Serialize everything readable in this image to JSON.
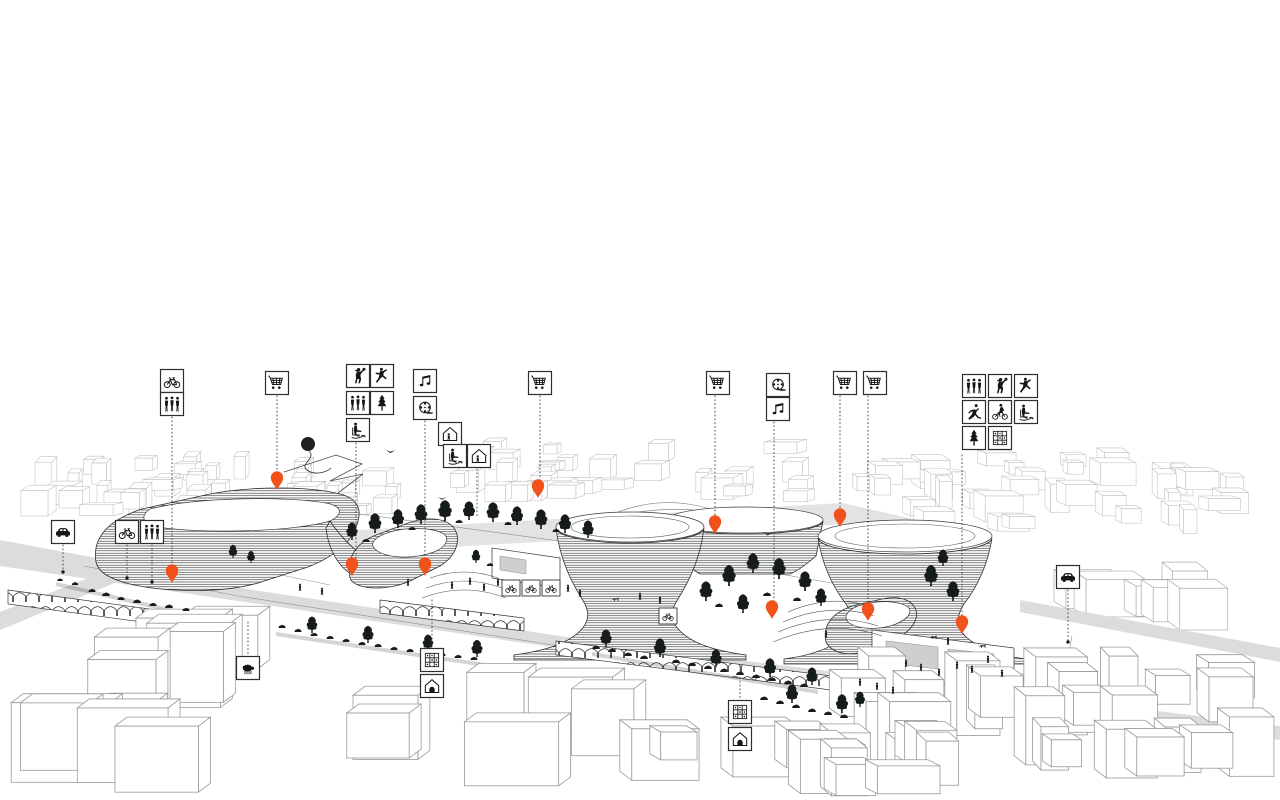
{
  "meta": {
    "type": "architectural-axonometric-masterplan-illustration",
    "canvas": {
      "w": 1280,
      "h": 800
    }
  },
  "colors": {
    "background": "#ffffff",
    "ink": "#1c1c1c",
    "pin": "#f1511b",
    "tree": "#161d18",
    "line_far": "#c4c4c4",
    "line_mid": "#aeaeae",
    "line_near": "#9a9a9a",
    "road": "#dcdcdc",
    "window": "#cfcfcf"
  },
  "legend": {
    "box_size": 23,
    "icons": [
      {
        "name": "car-icon",
        "symbol": "car",
        "x": 63,
        "y": 532
      },
      {
        "name": "bicycle-icon",
        "symbol": "bicycle",
        "x": 127,
        "y": 532
      },
      {
        "name": "pedestrians-icon",
        "symbol": "pedestrians",
        "x": 152,
        "y": 532
      },
      {
        "name": "bicycle-icon",
        "symbol": "bicycle",
        "x": 172,
        "y": 381
      },
      {
        "name": "pedestrians-icon",
        "symbol": "pedestrians",
        "x": 172,
        "y": 404
      },
      {
        "name": "shopping-icon",
        "symbol": "cart",
        "x": 277,
        "y": 383
      },
      {
        "name": "basketball-icon",
        "symbol": "basketball",
        "x": 358,
        "y": 376
      },
      {
        "name": "dance-icon",
        "symbol": "dancer",
        "x": 382,
        "y": 376
      },
      {
        "name": "pedestrians-icon",
        "symbol": "pedestrians",
        "x": 358,
        "y": 403
      },
      {
        "name": "tree-icon",
        "symbol": "tree",
        "x": 382,
        "y": 403
      },
      {
        "name": "rest-chair-icon",
        "symbol": "chairdog",
        "x": 358,
        "y": 430
      },
      {
        "name": "music-icon",
        "symbol": "music",
        "x": 425,
        "y": 381
      },
      {
        "name": "cinema-icon",
        "symbol": "film",
        "x": 425,
        "y": 408
      },
      {
        "name": "community-house-icon",
        "symbol": "houseperson",
        "x": 450,
        "y": 434
      },
      {
        "name": "rest-chair-icon",
        "symbol": "chairdog",
        "x": 455,
        "y": 456
      },
      {
        "name": "community-house-icon",
        "symbol": "houseperson",
        "x": 479,
        "y": 456
      },
      {
        "name": "shopping-icon",
        "symbol": "cart",
        "x": 540,
        "y": 383
      },
      {
        "name": "shopping-icon",
        "symbol": "cart",
        "x": 718,
        "y": 383
      },
      {
        "name": "cinema-icon",
        "symbol": "film",
        "x": 778,
        "y": 385
      },
      {
        "name": "music-icon",
        "symbol": "music",
        "x": 778,
        "y": 409
      },
      {
        "name": "shopping-icon",
        "symbol": "cart",
        "x": 845,
        "y": 383
      },
      {
        "name": "shopping-icon",
        "symbol": "cart",
        "x": 875,
        "y": 383
      },
      {
        "name": "pedestrians-icon",
        "symbol": "pedestrians",
        "x": 974,
        "y": 386
      },
      {
        "name": "basketball-icon",
        "symbol": "basketball",
        "x": 1000,
        "y": 386
      },
      {
        "name": "dance-icon",
        "symbol": "dancer",
        "x": 1026,
        "y": 386
      },
      {
        "name": "running-icon",
        "symbol": "runner",
        "x": 974,
        "y": 412
      },
      {
        "name": "cycling-icon",
        "symbol": "bmx",
        "x": 1000,
        "y": 412
      },
      {
        "name": "rest-chair-icon",
        "symbol": "chairdog",
        "x": 1026,
        "y": 412
      },
      {
        "name": "tree-icon",
        "symbol": "tree",
        "x": 974,
        "y": 438
      },
      {
        "name": "garden-plots-icon",
        "symbol": "grid",
        "x": 1000,
        "y": 438
      },
      {
        "name": "petting-farm-icon",
        "symbol": "sheep",
        "x": 248,
        "y": 668
      },
      {
        "name": "garden-plots-icon",
        "symbol": "grid",
        "x": 432,
        "y": 660
      },
      {
        "name": "housing-icon",
        "symbol": "homearch",
        "x": 432,
        "y": 686
      },
      {
        "name": "garden-plots-icon",
        "symbol": "grid",
        "x": 740,
        "y": 712
      },
      {
        "name": "housing-icon",
        "symbol": "homearch",
        "x": 740,
        "y": 739
      },
      {
        "name": "car-icon",
        "symbol": "car",
        "x": 1068,
        "y": 577
      }
    ]
  },
  "leader_lines": [
    [
      63,
      545,
      570
    ],
    [
      127,
      545,
      576
    ],
    [
      152,
      545,
      580
    ],
    [
      172,
      417,
      576
    ],
    [
      277,
      396,
      483
    ],
    [
      356,
      443,
      568
    ],
    [
      425,
      421,
      569
    ],
    [
      477,
      469,
      518
    ],
    [
      540,
      396,
      490
    ],
    [
      715,
      396,
      526
    ],
    [
      774,
      422,
      611
    ],
    [
      840,
      396,
      519
    ],
    [
      868,
      396,
      613
    ],
    [
      962,
      455,
      626
    ],
    [
      1068,
      590,
      640
    ],
    [
      248,
      622,
      655
    ],
    [
      432,
      600,
      647
    ],
    [
      740,
      666,
      699
    ]
  ],
  "ground_dots": [
    [
      63,
      572
    ],
    [
      127,
      578
    ],
    [
      152,
      582
    ],
    [
      1068,
      642
    ]
  ],
  "pins": [
    [
      172,
      583
    ],
    [
      277,
      490
    ],
    [
      352,
      576
    ],
    [
      425,
      576
    ],
    [
      538,
      498
    ],
    [
      715,
      534
    ],
    [
      840,
      527
    ],
    [
      772,
      619
    ],
    [
      868,
      621
    ],
    [
      962,
      634
    ]
  ],
  "scene_signs": [
    {
      "symbol": "bicycle",
      "x": 511,
      "y": 588
    },
    {
      "symbol": "bicycle",
      "x": 531,
      "y": 588
    },
    {
      "symbol": "bicycle",
      "x": 551,
      "y": 588
    },
    {
      "symbol": "bicycle",
      "x": 668,
      "y": 616
    }
  ],
  "balloon": {
    "x": 308,
    "y": 444,
    "r": 7
  },
  "birds": [
    [
      386,
      450,
      1.1
    ],
    [
      438,
      497,
      1.0
    ],
    [
      764,
      533,
      0.9
    ]
  ],
  "dogs": [
    [
      933,
      638
    ],
    [
      615,
      600
    ],
    [
      982,
      647
    ]
  ],
  "people": [
    [
      300,
      591
    ],
    [
      322,
      595
    ],
    [
      408,
      586
    ],
    [
      452,
      589
    ],
    [
      470,
      585
    ],
    [
      484,
      591
    ],
    [
      498,
      586
    ],
    [
      512,
      592
    ],
    [
      640,
      600
    ],
    [
      660,
      604
    ],
    [
      568,
      592
    ],
    [
      580,
      597
    ],
    [
      860,
      686
    ],
    [
      877,
      690
    ],
    [
      893,
      694
    ],
    [
      906,
      667
    ],
    [
      921,
      671
    ],
    [
      939,
      676
    ],
    [
      957,
      669
    ],
    [
      972,
      673
    ],
    [
      988,
      663
    ],
    [
      1002,
      677
    ],
    [
      948,
      645
    ],
    [
      826,
      638
    ]
  ],
  "trees": [
    [
      92,
      592,
      0.5,
      "b"
    ],
    [
      106,
      596,
      0.55,
      "b"
    ],
    [
      121,
      600,
      0.5,
      "b"
    ],
    [
      137,
      603,
      0.55,
      "b"
    ],
    [
      153,
      606,
      0.5,
      "b"
    ],
    [
      169,
      608,
      0.55,
      "b"
    ],
    [
      186,
      611,
      0.5,
      "b"
    ],
    [
      60,
      581,
      0.4,
      "b"
    ],
    [
      75,
      585,
      0.45,
      "b"
    ],
    [
      233,
      558,
      0.6,
      "p"
    ],
    [
      251,
      563,
      0.55,
      "p"
    ],
    [
      352,
      540,
      0.8,
      "p"
    ],
    [
      366,
      542,
      0.5,
      "b"
    ],
    [
      375,
      533,
      0.9,
      "p"
    ],
    [
      398,
      528,
      0.85,
      "p"
    ],
    [
      412,
      530,
      0.5,
      "b"
    ],
    [
      421,
      524,
      0.9,
      "p"
    ],
    [
      445,
      521,
      0.95,
      "p"
    ],
    [
      459,
      523,
      0.5,
      "b"
    ],
    [
      469,
      520,
      0.85,
      "p"
    ],
    [
      493,
      522,
      0.9,
      "p"
    ],
    [
      508,
      525,
      0.5,
      "b"
    ],
    [
      517,
      525,
      0.85,
      "p"
    ],
    [
      541,
      529,
      0.9,
      "p"
    ],
    [
      556,
      532,
      0.5,
      "b"
    ],
    [
      565,
      533,
      0.85,
      "p"
    ],
    [
      588,
      538,
      0.8,
      "p"
    ],
    [
      706,
      601,
      0.9,
      "p"
    ],
    [
      719,
      607,
      0.55,
      "b"
    ],
    [
      729,
      586,
      0.95,
      "p"
    ],
    [
      753,
      573,
      0.9,
      "p"
    ],
    [
      767,
      596,
      0.55,
      "b"
    ],
    [
      779,
      579,
      0.95,
      "p"
    ],
    [
      805,
      591,
      0.9,
      "p"
    ],
    [
      797,
      601,
      0.55,
      "b"
    ],
    [
      743,
      613,
      0.85,
      "p"
    ],
    [
      821,
      606,
      0.8,
      "p"
    ],
    [
      931,
      586,
      0.95,
      "p"
    ],
    [
      953,
      601,
      0.9,
      "p"
    ],
    [
      943,
      566,
      0.75,
      "p"
    ],
    [
      596,
      649,
      0.55,
      "b"
    ],
    [
      612,
      652,
      0.55,
      "b"
    ],
    [
      606,
      647,
      0.8,
      "p"
    ],
    [
      628,
      656,
      0.55,
      "b"
    ],
    [
      644,
      659,
      0.55,
      "b"
    ],
    [
      660,
      657,
      0.85,
      "p"
    ],
    [
      676,
      663,
      0.55,
      "b"
    ],
    [
      692,
      666,
      0.55,
      "b"
    ],
    [
      708,
      669,
      0.55,
      "b"
    ],
    [
      716,
      667,
      0.8,
      "p"
    ],
    [
      724,
      672,
      0.55,
      "b"
    ],
    [
      740,
      675,
      0.55,
      "b"
    ],
    [
      756,
      678,
      0.55,
      "b"
    ],
    [
      770,
      677,
      0.85,
      "p"
    ],
    [
      772,
      681,
      0.55,
      "b"
    ],
    [
      788,
      684,
      0.55,
      "b"
    ],
    [
      804,
      687,
      0.55,
      "b"
    ],
    [
      812,
      685,
      0.8,
      "p"
    ],
    [
      282,
      628,
      0.5,
      "b"
    ],
    [
      298,
      632,
      0.5,
      "b"
    ],
    [
      312,
      633,
      0.75,
      "p"
    ],
    [
      314,
      636,
      0.5,
      "b"
    ],
    [
      330,
      639,
      0.5,
      "b"
    ],
    [
      346,
      642,
      0.5,
      "b"
    ],
    [
      362,
      645,
      0.5,
      "b"
    ],
    [
      368,
      643,
      0.78,
      "p"
    ],
    [
      378,
      647,
      0.5,
      "b"
    ],
    [
      394,
      650,
      0.5,
      "b"
    ],
    [
      410,
      652,
      0.5,
      "b"
    ],
    [
      426,
      654,
      0.5,
      "b"
    ],
    [
      428,
      651,
      0.75,
      "p"
    ],
    [
      442,
      656,
      0.5,
      "b"
    ],
    [
      458,
      658,
      0.5,
      "b"
    ],
    [
      474,
      660,
      0.5,
      "b"
    ],
    [
      477,
      657,
      0.78,
      "p"
    ],
    [
      764,
      700,
      0.55,
      "b"
    ],
    [
      780,
      704,
      0.55,
      "b"
    ],
    [
      792,
      703,
      0.85,
      "p"
    ],
    [
      796,
      708,
      0.55,
      "b"
    ],
    [
      812,
      712,
      0.55,
      "b"
    ],
    [
      828,
      715,
      0.55,
      "b"
    ],
    [
      842,
      713,
      0.85,
      "p"
    ],
    [
      844,
      718,
      0.55,
      "b"
    ],
    [
      860,
      707,
      0.7,
      "p"
    ],
    [
      476,
      563,
      0.6,
      "p"
    ],
    [
      490,
      566,
      0.45,
      "b"
    ]
  ],
  "city_clusters": [
    {
      "layer": "far",
      "seed": 11,
      "x": 2,
      "y": 455,
      "w": 248,
      "h": 75,
      "count": 24,
      "bw": [
        10,
        34
      ],
      "bh": [
        10,
        28
      ],
      "dir": 1,
      "stroke": "#c4c4c4",
      "lw": 0.6
    },
    {
      "layer": "far",
      "seed": 23,
      "x": 258,
      "y": 460,
      "w": 160,
      "h": 58,
      "count": 13,
      "bw": [
        10,
        30
      ],
      "bh": [
        8,
        24
      ],
      "dir": 1,
      "stroke": "#c4c4c4",
      "lw": 0.6
    },
    {
      "layer": "far",
      "seed": 37,
      "x": 424,
      "y": 440,
      "w": 404,
      "h": 62,
      "count": 30,
      "bw": [
        12,
        36
      ],
      "bh": [
        8,
        22
      ],
      "dir": 1,
      "stroke": "#c4c4c4",
      "lw": 0.6
    },
    {
      "layer": "far",
      "seed": 51,
      "x": 838,
      "y": 452,
      "w": 306,
      "h": 86,
      "count": 26,
      "bw": [
        12,
        38
      ],
      "bh": [
        10,
        30
      ],
      "dir": -1,
      "stroke": "#c4c4c4",
      "lw": 0.6
    },
    {
      "layer": "far",
      "seed": 67,
      "x": 1148,
      "y": 468,
      "w": 130,
      "h": 80,
      "count": 11,
      "bw": [
        12,
        34
      ],
      "bh": [
        12,
        30
      ],
      "dir": -1,
      "stroke": "#c4c4c4",
      "lw": 0.6
    },
    {
      "layer": "far",
      "seed": 73,
      "x": 1040,
      "y": 556,
      "w": 200,
      "h": 86,
      "count": 7,
      "bw": [
        26,
        60
      ],
      "bh": [
        20,
        48
      ],
      "dir": -1,
      "stroke": "#aeaeae",
      "lw": 0.7
    },
    {
      "layer": "near",
      "seed": 81,
      "x": 28,
      "y": 612,
      "w": 300,
      "h": 112,
      "count": 6,
      "bw": [
        52,
        96
      ],
      "bh": [
        48,
        90
      ],
      "dir": 1,
      "stroke": "#9a9a9a",
      "lw": 0.8
    },
    {
      "layer": "near",
      "seed": 91,
      "x": 0,
      "y": 702,
      "w": 230,
      "h": 92,
      "count": 5,
      "bw": [
        56,
        110
      ],
      "bh": [
        44,
        88
      ],
      "dir": 1,
      "stroke": "#9a9a9a",
      "lw": 0.8
    },
    {
      "layer": "near",
      "seed": 101,
      "x": 330,
      "y": 664,
      "w": 310,
      "h": 128,
      "count": 6,
      "bw": [
        48,
        100
      ],
      "bh": [
        44,
        96
      ],
      "dir": 1,
      "stroke": "#9a9a9a",
      "lw": 0.8
    },
    {
      "layer": "near",
      "seed": 111,
      "x": 828,
      "y": 652,
      "w": 446,
      "h": 142,
      "count": 24,
      "bw": [
        26,
        62
      ],
      "bh": [
        28,
        78
      ],
      "dir": -1,
      "stroke": "#9a9a9a",
      "lw": 0.8
    },
    {
      "layer": "near",
      "seed": 121,
      "x": 600,
      "y": 722,
      "w": 500,
      "h": 76,
      "count": 14,
      "bw": [
        30,
        70
      ],
      "bh": [
        26,
        60
      ],
      "dir": -1,
      "stroke": "#9a9a9a",
      "lw": 0.8
    }
  ]
}
